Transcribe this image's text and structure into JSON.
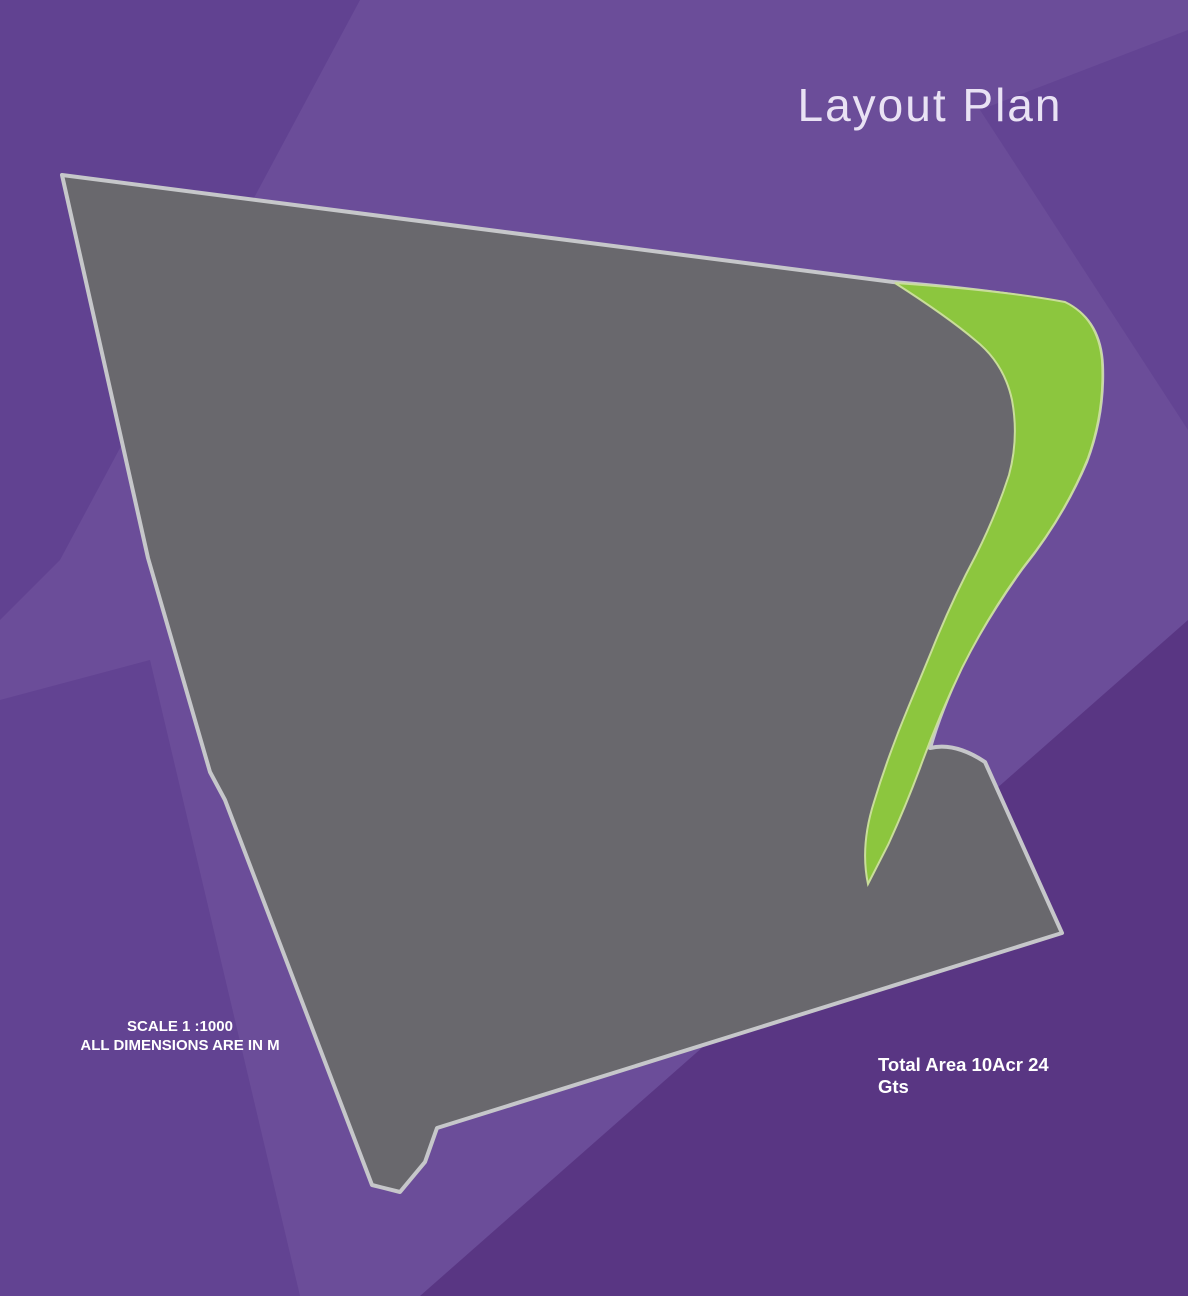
{
  "title": "Layout Plan",
  "gate_label": "GATE",
  "scale_note": {
    "line1": "SCALE 1 :1000",
    "line2": "ALL DIMENSIONS ARE IN M"
  },
  "compass": {
    "n": "N",
    "e": "E",
    "s": "S",
    "w": "W"
  },
  "park": {
    "line1": "PARK",
    "line2": "2210 SQYDS",
    "line3": "CHILDREN'S",
    "line4": "PLAY AREA"
  },
  "legend": {
    "title": "Total Area 10Acr 24 Gts",
    "rows": [
      {
        "key": "A",
        "desc": "36'x50'+ 200 Sq. Yds.",
        "color": "#f6dcd2"
      },
      {
        "key": "B",
        "desc": "30'x50'+ 167 Sq. Yds.",
        "color": "#fcf6d5"
      },
      {
        "key": "C",
        "desc": "36'x50'+ 200 Sq. Yds.",
        "color": "#cbe06a"
      },
      {
        "key": "D",
        "desc": "Mixes Sizes",
        "color": "#f7c8de"
      }
    ]
  },
  "plot_areas": {
    "A": "200",
    "B": "167",
    "C": "200"
  },
  "auto_dims": {
    "top": "50'-0\"",
    "side_a": "36'-0\"",
    "side_b": "30'-0\"",
    "bottom": "50'-0\"",
    "row_top": "36'-0\"",
    "row_alt": "35'-11\""
  },
  "blocks": [
    {
      "name": "strip-1",
      "cols": [
        {
          "d": {
            "id": "D-12",
            "area": "285"
          },
          "plots": [
            "B-37",
            "B-36",
            "B-35",
            "B-34",
            "B-33",
            "B-32",
            "B-31",
            "B-30",
            "B-29",
            "A-30",
            "A-29",
            "A-28",
            "A-27",
            "C-4",
            "C-3",
            "C-2",
            "C-1"
          ]
        }
      ]
    },
    {
      "name": "strip-2",
      "cols": [
        {
          "d": {
            "id": "D-11",
            "area": "225"
          },
          "plots": [
            "B-22",
            "B-23",
            "B-24",
            "B-25",
            "B-26",
            "B-27",
            "B-28"
          ]
        },
        {
          "d": {
            "id": "D-10",
            "area": "261"
          },
          "plots": [
            "B-21",
            "B-20",
            "B-19",
            "B-18",
            "B-17",
            "B-16"
          ]
        }
      ]
    },
    {
      "name": "strip-3",
      "cols": [
        {
          "d": {
            "id": "D-9",
            "area": "219"
          },
          "plots": [
            "B-11",
            "B-12",
            "B-13",
            "B-14",
            "B-15"
          ]
        },
        {
          "d": {
            "id": "D-8",
            "area": "260"
          },
          "plots": [
            "B-10",
            "B-9",
            "B-8",
            "B-7"
          ]
        }
      ]
    },
    {
      "name": "strip-4",
      "cols": [
        {
          "d": {
            "id": "D-7",
            "area": "228"
          },
          "plots": [
            "B-4",
            "B-5",
            "B-6"
          ]
        },
        {
          "d": {
            "id": "D-6",
            "area": "270"
          },
          "plots": [
            "B-3",
            "B-2"
          ]
        }
      ]
    },
    {
      "name": "strip-5",
      "cols": [
        {
          "d": {
            "id": "D-5",
            "area": "232"
          },
          "plots": [
            "B-1"
          ]
        },
        {
          "d": {
            "id": "D-4",
            "area": "262"
          },
          "plots": []
        }
      ]
    },
    {
      "name": "block-a31",
      "cols": [
        {
          "plots": [
            "A-31",
            "A-32",
            "A-33",
            "A-34",
            "A-35",
            "A-36",
            "A-37",
            "A-38"
          ]
        },
        {
          "plots": [
            "A-46",
            "A-45",
            "A-44",
            "A-43",
            "A-42",
            "A-41",
            "A-40",
            "A-39"
          ]
        }
      ]
    },
    {
      "name": "block-a47",
      "cols": [
        {
          "plots": [
            "A-47",
            "A-48",
            "A-49",
            "A-50",
            "A-51",
            "A-52",
            "A-53",
            "A-54"
          ]
        },
        {
          "plots": [
            "A-62",
            "A-61",
            "A-60",
            "A-59",
            "A-58",
            "A-57",
            "A-56",
            "A-55"
          ]
        }
      ]
    },
    {
      "name": "block-a63",
      "cols": [
        {
          "plots": [
            "A-63",
            "A-64",
            "A-65",
            "A-66",
            "A-67",
            "A-68",
            "A-69",
            "A-70"
          ]
        },
        {
          "plots": [
            "A-78",
            "A-77",
            "A-76",
            "A-75",
            "A-74",
            "A-73",
            "A-72",
            "A-71"
          ]
        }
      ]
    },
    {
      "name": "block-a79",
      "cols": [
        {
          "plots": [
            "A-79",
            "A-80",
            "A-81",
            "A-82",
            "A-83",
            "A-84",
            "A-85",
            "A-86"
          ]
        },
        {
          "plots": [
            "A-94",
            "A-93",
            "A-92",
            "A-91",
            "A-90",
            "A-89",
            "A-88",
            "A-87"
          ]
        }
      ]
    },
    {
      "name": "strip-a95",
      "cols": [
        {
          "d": {
            "id": "D-3",
            "area": "206"
          },
          "plots": [
            "A-95",
            "A-96",
            "A-97",
            "A-98"
          ]
        }
      ]
    },
    {
      "name": "bottom-strip",
      "rows": [
        [
          "A-26",
          "A-25",
          "A-24",
          "A-23",
          "A-22",
          "A-21",
          "A-20",
          "A-19",
          "A-18",
          "A-17",
          "A-16",
          "A-15",
          "A-14",
          "D-2"
        ],
        [
          "A-1",
          "A-2",
          "A-3",
          "A-4",
          "A-5",
          "A-6",
          "A-7",
          "A-8",
          "A-9",
          "A-10",
          "A-11",
          "A-12",
          "A-13",
          "D-1"
        ]
      ],
      "d_areas": {
        "D-2": "276",
        "D-1": "223"
      }
    }
  ],
  "road_labels": [
    {
      "text": "30'-0\" WIDE ROAD",
      "x": 437,
      "y": 236,
      "rot": 5
    },
    {
      "text": "30'-0\" WIDE ROAD",
      "x": 299,
      "y": 597,
      "rot": 70
    },
    {
      "text": "30'-0\" WIDE ROAD",
      "x": 421,
      "y": 505,
      "rot": 70
    },
    {
      "text": "30'-0\" WIDE ROAD",
      "x": 566,
      "y": 440,
      "rot": 70
    },
    {
      "text": "30'-0\" WIDE ROAD",
      "x": 753,
      "y": 428,
      "rot": 70
    },
    {
      "text": "30'-0\" WIDE ROAD",
      "x": 941,
      "y": 522,
      "rot": 70
    },
    {
      "text": "30'-0\" WIDE ROAD",
      "x": 1028,
      "y": 826,
      "rot": 72
    },
    {
      "text": "40'-0\" WIDE ROAD",
      "x": 826,
      "y": 361,
      "rot": -15
    },
    {
      "text": "40'-0\" WIDE ROAD",
      "x": 640,
      "y": 854,
      "rot": -18
    },
    {
      "text": "40'-0\" WIDE ROAD",
      "x": 947,
      "y": 746,
      "rot": -16
    },
    {
      "text": "60'-0\" WIDE ROAD",
      "x": 608,
      "y": 1056,
      "rot": -19
    },
    {
      "text": "60'-0\" WIDE ROAD",
      "x": 868,
      "y": 957,
      "rot": -19
    }
  ],
  "dims": [
    {
      "t": "55'5\"",
      "x": 120,
      "y": 233,
      "r": -10
    },
    {
      "t": "63'-2\"",
      "x": 97,
      "y": 261,
      "r": 64
    },
    {
      "t": "39'-3\"",
      "x": 153,
      "y": 255,
      "r": 58
    },
    {
      "t": "50'0\"",
      "x": 135,
      "y": 287,
      "r": -18
    },
    {
      "t": "55'4\"",
      "x": 224,
      "y": 246,
      "r": -10
    },
    {
      "t": "52'-6\"",
      "x": 206,
      "y": 270,
      "r": 64
    },
    {
      "t": "28'-9\"",
      "x": 253,
      "y": 261,
      "r": 58
    },
    {
      "t": "55'3\"",
      "x": 288,
      "y": 259,
      "r": -10
    },
    {
      "t": "58'-9\"",
      "x": 270,
      "y": 282,
      "r": 64
    },
    {
      "t": "35'-1\"",
      "x": 319,
      "y": 285,
      "r": 58
    },
    {
      "t": "55'1\"",
      "x": 398,
      "y": 266,
      "r": -10
    },
    {
      "t": "50'-11\"",
      "x": 377,
      "y": 289,
      "r": 64
    },
    {
      "t": "27'-11\"",
      "x": 429,
      "y": 272,
      "r": 58
    },
    {
      "t": "54'9\"",
      "x": 463,
      "y": 273,
      "r": -10
    },
    {
      "t": "57'-11\"",
      "x": 447,
      "y": 302,
      "r": 64
    },
    {
      "t": "35'-7\"",
      "x": 493,
      "y": 288,
      "r": 58
    },
    {
      "t": "54'8\"",
      "x": 568,
      "y": 279,
      "r": -10
    },
    {
      "t": "52'-2\"",
      "x": 551,
      "y": 303,
      "r": 64
    },
    {
      "t": "30'-0\"",
      "x": 599,
      "y": 293,
      "r": 58
    },
    {
      "t": "54'11\"",
      "x": 634,
      "y": 284,
      "r": -9
    },
    {
      "t": "37'-4\"",
      "x": 667,
      "y": 301,
      "r": 60
    },
    {
      "t": "30'0\"",
      "x": 711,
      "y": 290,
      "r": -9
    },
    {
      "t": "25'6\"",
      "x": 747,
      "y": 294,
      "r": -9
    },
    {
      "t": "53'-6\"",
      "x": 700,
      "y": 317,
      "r": 64
    },
    {
      "t": "55'8\"",
      "x": 813,
      "y": 295,
      "r": -9
    },
    {
      "t": "59'-5\"",
      "x": 791,
      "y": 319,
      "r": 64
    },
    {
      "t": "34'-10\"",
      "x": 847,
      "y": 312,
      "r": 58
    },
    {
      "t": "49'-11\"",
      "x": 823,
      "y": 341,
      "r": -14
    },
    {
      "t": "32'-4\"",
      "x": 884,
      "y": 281,
      "r": 58
    },
    {
      "t": "57'7\"",
      "x": 940,
      "y": 307,
      "r": -7
    },
    {
      "t": "51'-5\"",
      "x": 905,
      "y": 335,
      "r": 62
    },
    {
      "t": "22'-11\"",
      "x": 1014,
      "y": 315,
      "r": 58
    },
    {
      "t": "55'-0\"",
      "x": 957,
      "y": 776,
      "r": -20
    },
    {
      "t": "50'-0\"",
      "x": 947,
      "y": 791,
      "r": 70
    },
    {
      "t": "45'-0\"",
      "x": 1002,
      "y": 812,
      "r": -20
    },
    {
      "t": "50'-0\"",
      "x": 955,
      "y": 838,
      "r": 70
    },
    {
      "t": "35'-4\"",
      "x": 1004,
      "y": 880,
      "r": -20
    }
  ],
  "colors": {
    "bg": "#6b4d99",
    "bg_dark": "#5e3f8f",
    "bg_dark2": "#56337f",
    "road": "#69686d",
    "site_border": "#c6c7ca",
    "plot_a": "#f6dcd2",
    "plot_b": "#fcf6d5",
    "plot_c": "#cbe06a",
    "plot_d": "#f7c8de",
    "plot_border": "#55504b",
    "plot_text": "#1899d6",
    "park": "#8cc63e",
    "tree": "#1c6d22",
    "strip_green": "#8cc63e",
    "title": "#e9e2f4"
  }
}
